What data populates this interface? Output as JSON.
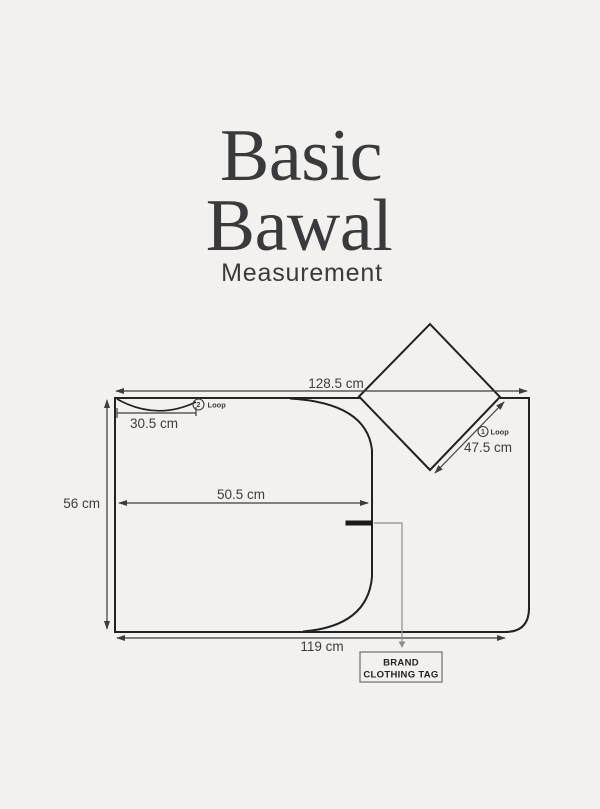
{
  "title": {
    "line1": "Basic",
    "line2": "Bawal",
    "subtitle": "Measurement"
  },
  "measurements": {
    "top_width": "128.5 cm",
    "loop2_width": "30.5 cm",
    "side_height": "56 cm",
    "inner_width": "50.5 cm",
    "bottom_width": "119 cm",
    "loop1_length": "47.5 cm"
  },
  "loops": {
    "loop1": {
      "num": "1",
      "label": "Loop"
    },
    "loop2": {
      "num": "2",
      "label": "Loop"
    }
  },
  "tag": {
    "line1": "BRAND",
    "line2": "CLOTHING TAG"
  },
  "colors": {
    "background": "#f2f1ef",
    "ink": "#222222",
    "title": "#3a3a3c",
    "measure": "#3d3d3d",
    "leader": "#8f8f8f",
    "tag-border": "#6f6f6f",
    "tag-bar": "#1b1b1b"
  }
}
